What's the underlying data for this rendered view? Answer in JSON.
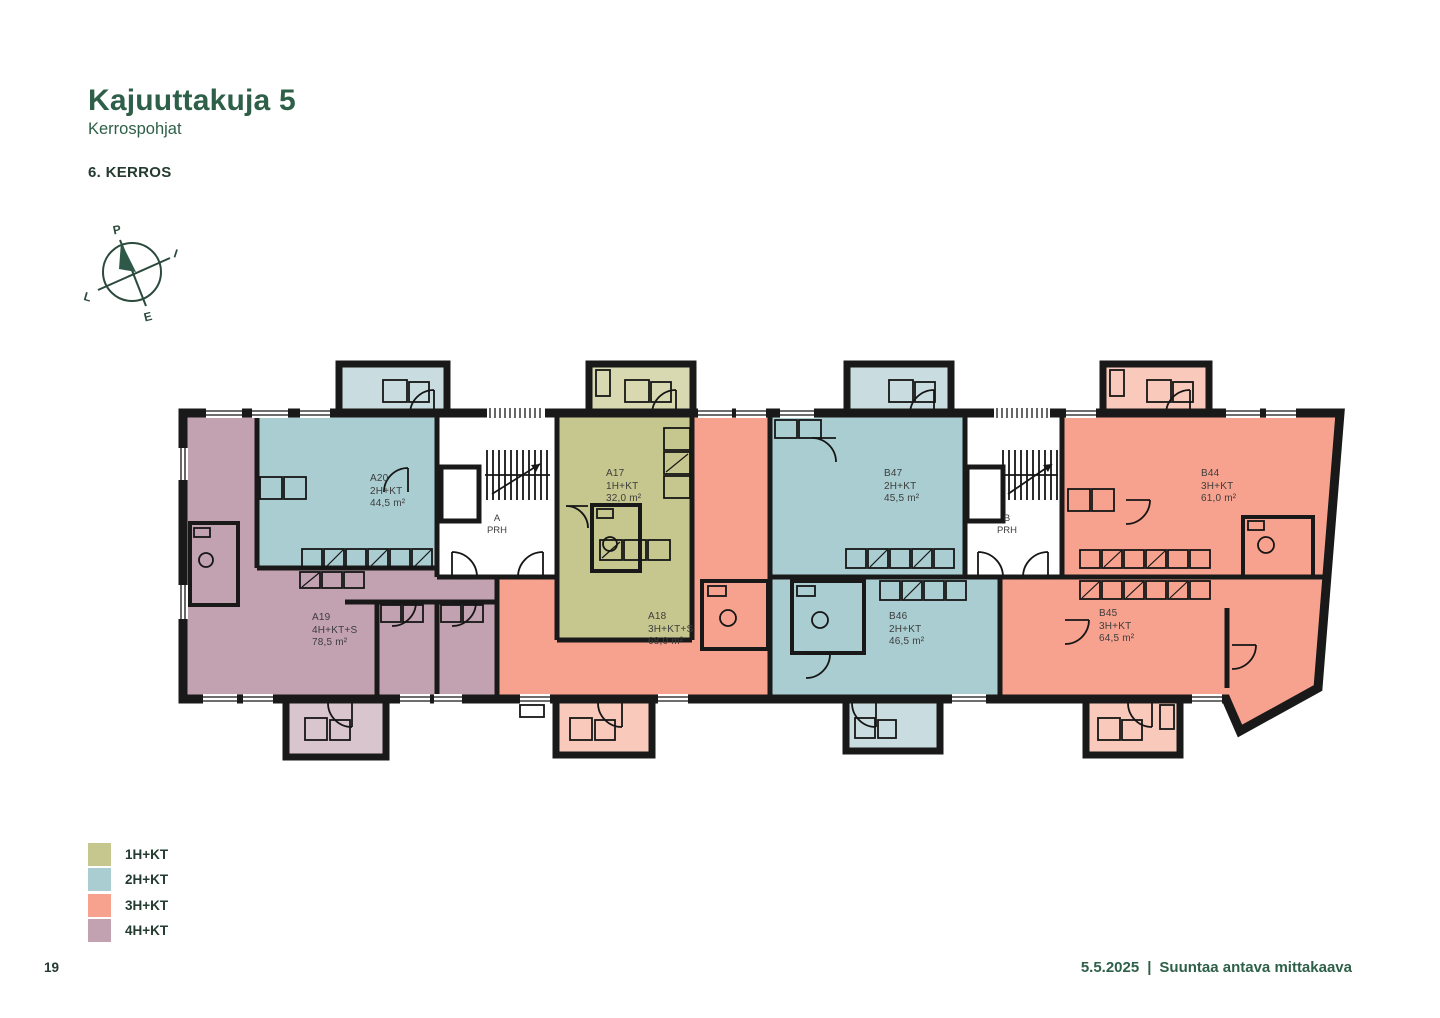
{
  "header": {
    "title": "Kajuuttakuja 5",
    "subtitle": "Kerrospohjat",
    "floor_label": "6. KERROS"
  },
  "compass": {
    "north": "P",
    "east": "I",
    "south": "E",
    "west": "L"
  },
  "apartments": [
    {
      "id": "A20",
      "type": "2H+KT",
      "area": "44,5 m²"
    },
    {
      "id": "A17",
      "type": "1H+KT",
      "area": "32,0 m²"
    },
    {
      "id": "B47",
      "type": "2H+KT",
      "area": "45,5 m²"
    },
    {
      "id": "B44",
      "type": "3H+KT",
      "area": "61,0 m²"
    },
    {
      "id": "A19",
      "type": "4H+KT+S",
      "area": "78,5 m²"
    },
    {
      "id": "A18",
      "type": "3H+KT+S",
      "area": "68,0 m²"
    },
    {
      "id": "B46",
      "type": "2H+KT",
      "area": "46,5 m²"
    },
    {
      "id": "B45",
      "type": "3H+KT",
      "area": "64,5 m²"
    }
  ],
  "stairwells": [
    {
      "letter": "A",
      "label": "PRH"
    },
    {
      "letter": "B",
      "label": "PRH"
    }
  ],
  "legend": [
    {
      "label": "1H+KT",
      "color": "#c6c78e"
    },
    {
      "label": "2H+KT",
      "color": "#aacdd1"
    },
    {
      "label": "3H+KT",
      "color": "#f7a28e"
    },
    {
      "label": "4H+KT",
      "color": "#c2a2b0"
    }
  ],
  "footer": {
    "page_number": "19",
    "date": "5.5.2025",
    "separator": "|",
    "note": "Suuntaa antava mittakaava"
  },
  "plan_colors": {
    "c-1h": "#c6c78e",
    "c-2h": "#aacdd1",
    "c-3h": "#f7a28e",
    "c-4h": "#c2a2b0",
    "c-1h-light": "#d8d9b0",
    "c-2h-light": "#c9dde0",
    "c-3h-light": "#f9cabb",
    "c-4h-light": "#d9c5ce",
    "wall": "#191919",
    "text-green": "#2e6049"
  }
}
